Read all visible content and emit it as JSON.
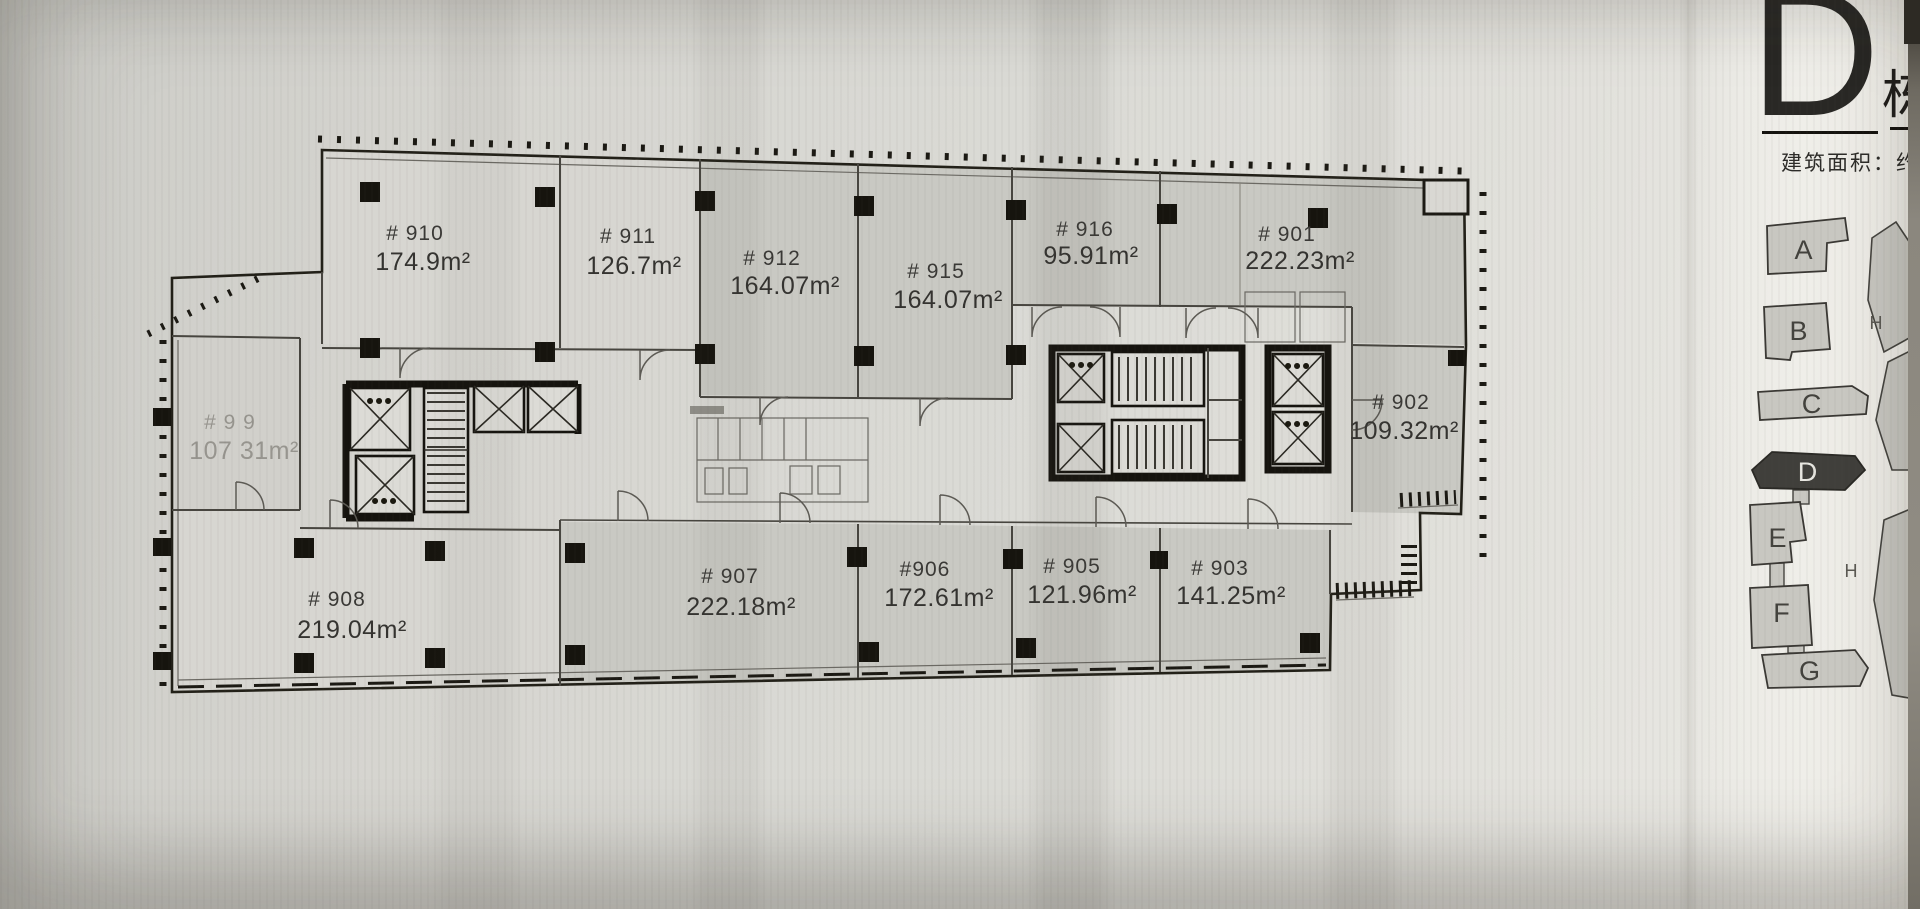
{
  "page": {
    "building_letter": "D",
    "building_suffix": "栋",
    "area_caption": "建筑面积：约"
  },
  "plan": {
    "units": [
      {
        "id": "# 910",
        "area": "174.9m²"
      },
      {
        "id": "# 911",
        "area": "126.7m²"
      },
      {
        "id": "# 912",
        "area": "164.07m²"
      },
      {
        "id": "# 915",
        "area": "164.07m²"
      },
      {
        "id": "# 916",
        "area": "95.91m²"
      },
      {
        "id": "# 901",
        "area": "222.23m²"
      },
      {
        "id": "# 902",
        "area": "109.32m²"
      },
      {
        "id": "# 9 9",
        "area": "107 31m²"
      },
      {
        "id": "# 908",
        "area": "219.04m²"
      },
      {
        "id": "# 907",
        "area": "222.18m²"
      },
      {
        "id": "#906",
        "area": "172.61m²"
      },
      {
        "id": "# 905",
        "area": "121.96m²"
      },
      {
        "id": "# 903",
        "area": "141.25m²"
      }
    ]
  },
  "key_map": {
    "buildings": [
      {
        "label": "A",
        "highlighted": false
      },
      {
        "label": "B",
        "highlighted": false
      },
      {
        "label": "C",
        "highlighted": false
      },
      {
        "label": "D",
        "highlighted": true
      },
      {
        "label": "E",
        "highlighted": false
      },
      {
        "label": "F",
        "highlighted": false
      },
      {
        "label": "G",
        "highlighted": false
      }
    ],
    "road_labels": [
      "H",
      "H"
    ],
    "highlight_color": "#403f3b",
    "building_fill": "#c8c7c1"
  }
}
